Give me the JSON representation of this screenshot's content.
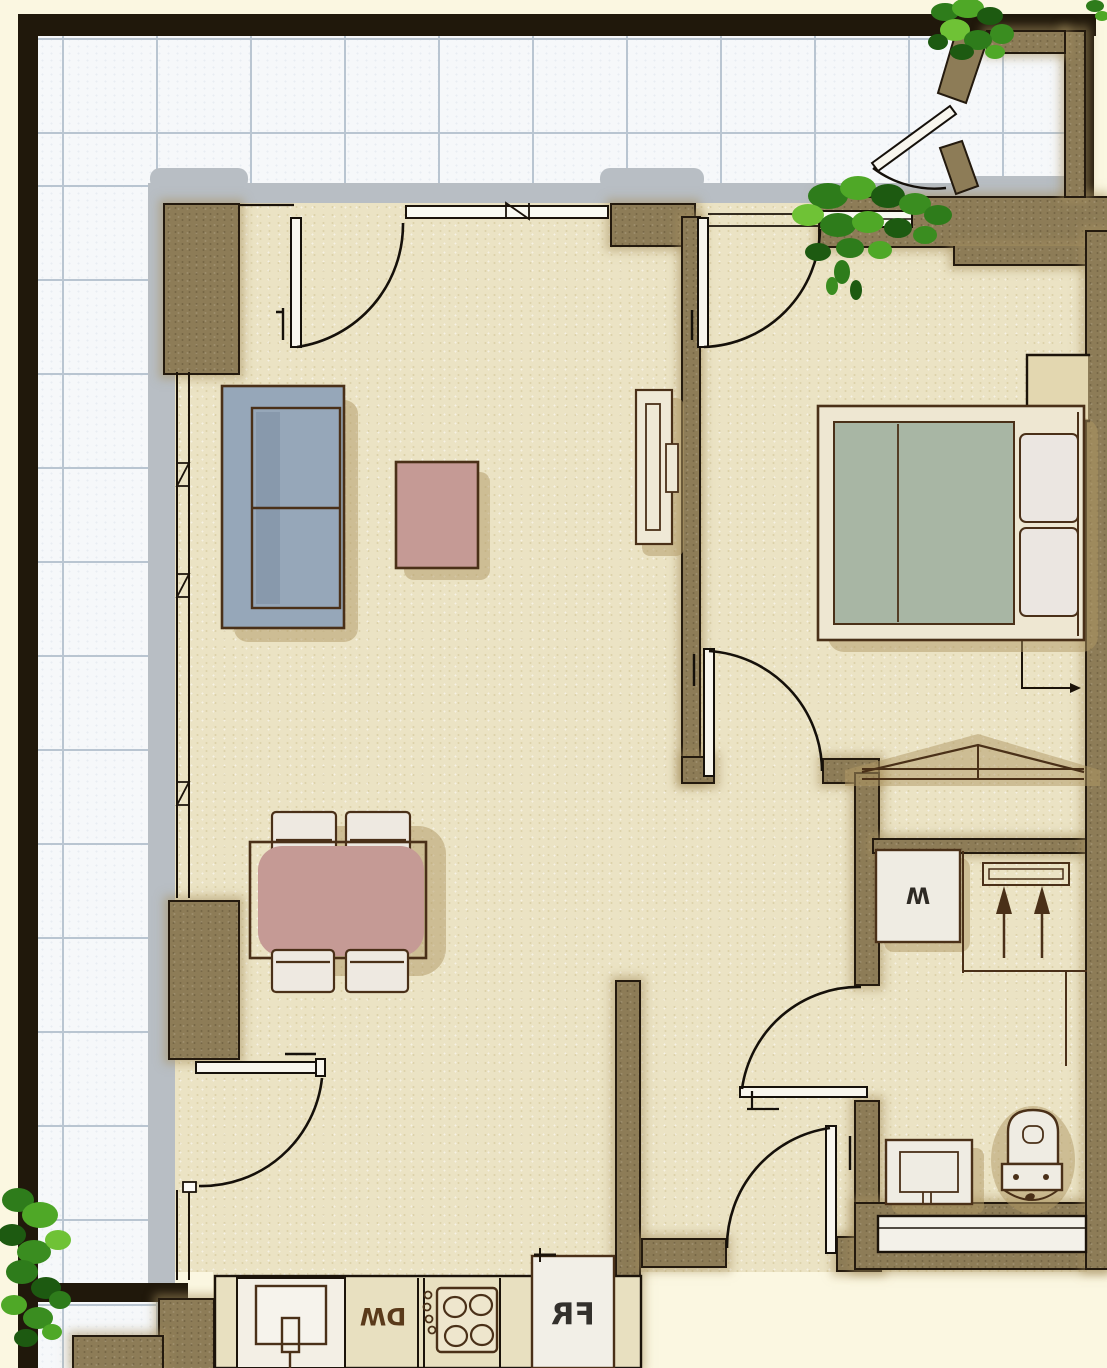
{
  "floorplan": {
    "labels": {
      "dishwasher": "DW",
      "fridge": "FR",
      "washer": "W"
    },
    "colors": {
      "background": "#fbf7e1",
      "dark_outer_wall": "#20180b",
      "wall_brown": "#8d7c57",
      "terrace_tile": "#f6f8fa",
      "tile_grid_line": "#b9c5d1",
      "glazing_gray": "#b8bec4",
      "floor_cream": "#ebe3c4",
      "furniture_outline": "#4a3018",
      "sofa_blue": "#96a7b9",
      "table_pink": "#c59a95",
      "bed_green": "#a8b6a4",
      "linen_white": "#eee9e1",
      "shadow_tan": "#b09863",
      "plant_dark_green": "#1d5a11",
      "plant_mid_green": "#2e7c1b",
      "plant_light_green": "#6fc236"
    }
  }
}
